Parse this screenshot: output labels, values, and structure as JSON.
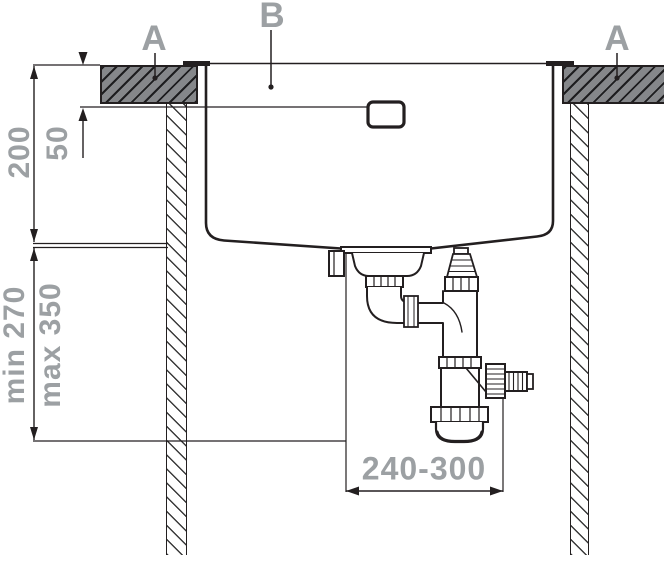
{
  "diagram": {
    "title": "sink-installation-cross-section",
    "markers": {
      "a_left": "A",
      "b_center": "B",
      "a_right": "A"
    },
    "dimensions": {
      "bowl_depth": "200",
      "overflow_offset": "50",
      "trap_height_min": "min 270",
      "trap_height_max": "max 350",
      "drain_horizontal_range": "240-300"
    },
    "colors": {
      "annotation_gray": "#9CA0A3",
      "line_black": "#231F20",
      "countertop_fill": "#85878A"
    }
  }
}
